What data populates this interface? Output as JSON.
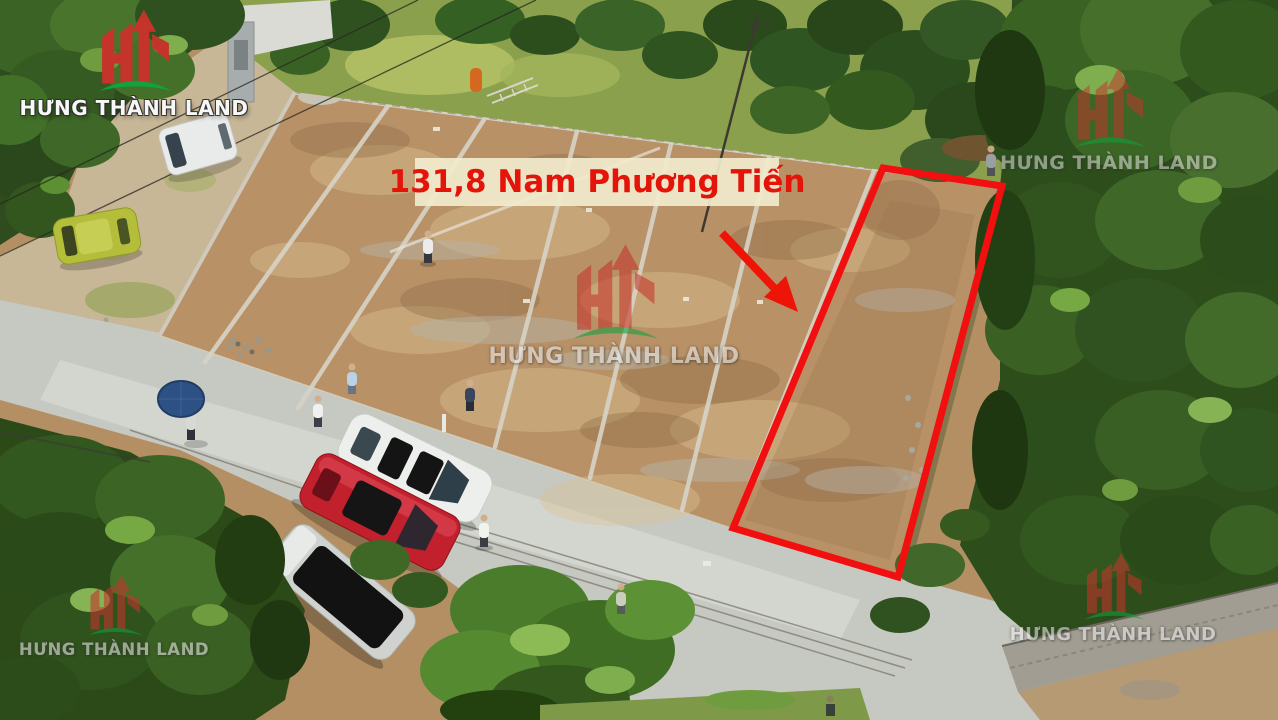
{
  "annotation": {
    "plot_label": "131,8 Nam Phương Tiến",
    "label_text_color": "#e4140a",
    "label_background": "#f1ebcd",
    "plot_outline_color": "#f10f0f",
    "arrow_color": "#ee1408"
  },
  "brand": {
    "name": "HƯNG THÀNH LAND",
    "monogram": "HT",
    "logo_red": "#c5342b",
    "logo_green": "#0fa23e"
  }
}
